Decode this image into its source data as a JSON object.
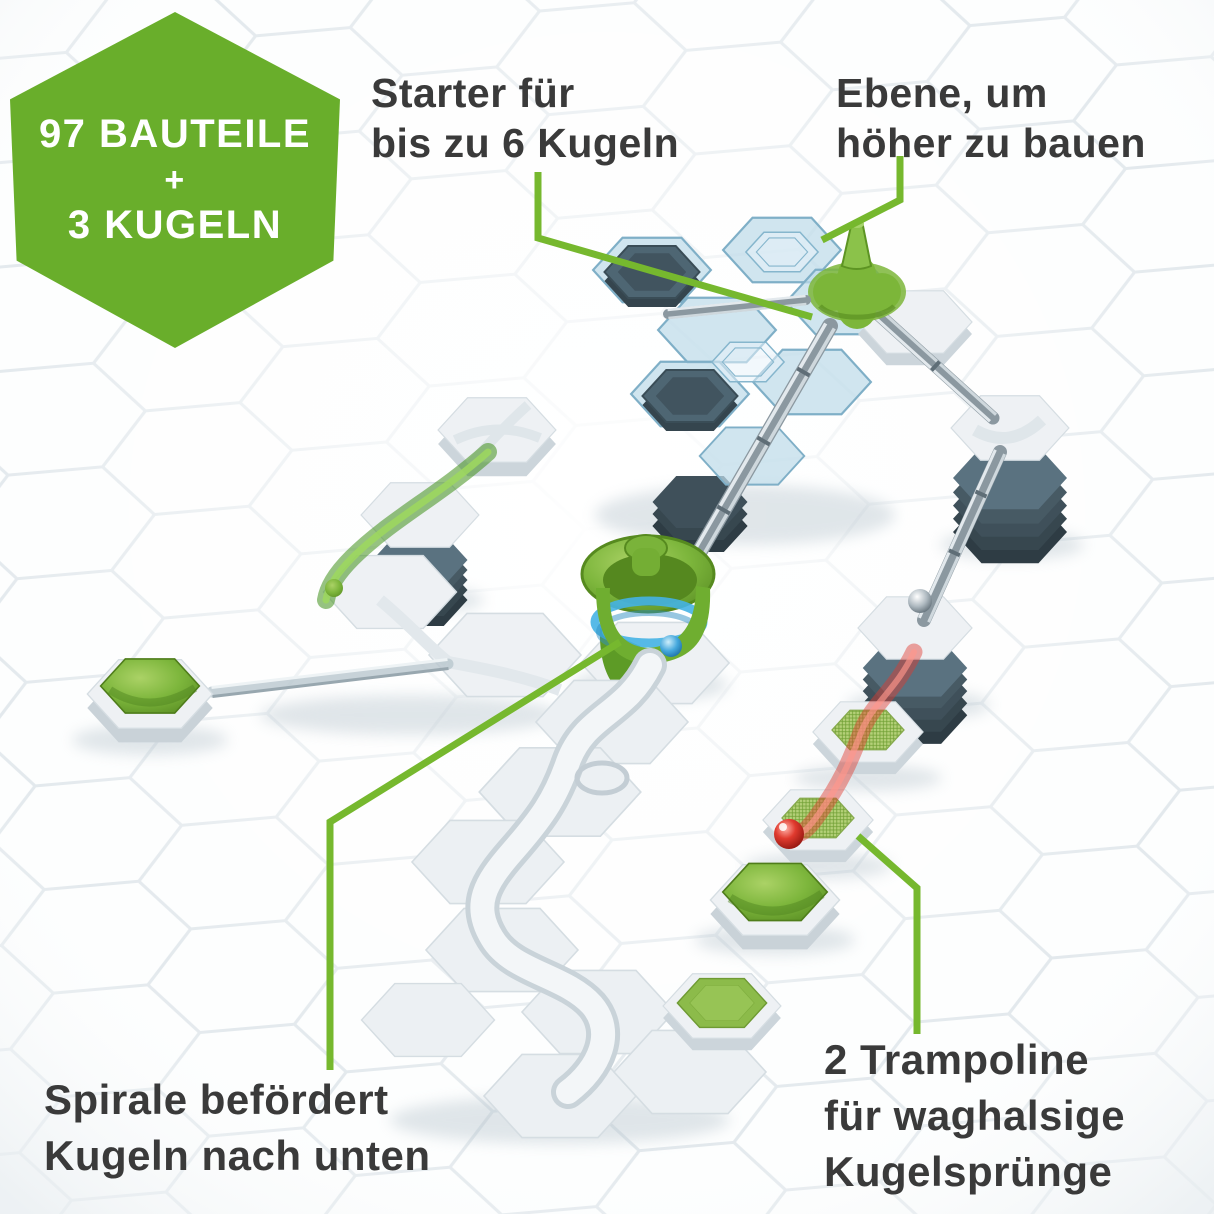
{
  "badge": {
    "lines": [
      "97 BAUTEILE",
      "+",
      "3 KUGELN"
    ],
    "bg_color": "#69ae2b"
  },
  "callouts": {
    "starter": {
      "line1": "Starter für",
      "line2": "bis zu 6 Kugeln"
    },
    "level": {
      "line1": "Ebene, um",
      "line2": "höher zu bauen"
    },
    "spiral": {
      "line1": "Spirale befördert",
      "line2": "Kugeln nach unten"
    },
    "trampoline": {
      "line1": "2 Trampoline",
      "line2": "für waghalsige",
      "line3": "Kugelsprünge"
    }
  },
  "colors": {
    "accent_green": "#76b82e",
    "badge_green": "#69ae2b",
    "text_dark": "#3a3a3a",
    "piece_green": "#7cb63a",
    "blue_plate": "#bedbe9",
    "slate_tower": "#546b78",
    "red_trajectory": "#d94a41",
    "blue_marble": "#2e9ad1",
    "white_tile": "#eef1f4"
  }
}
